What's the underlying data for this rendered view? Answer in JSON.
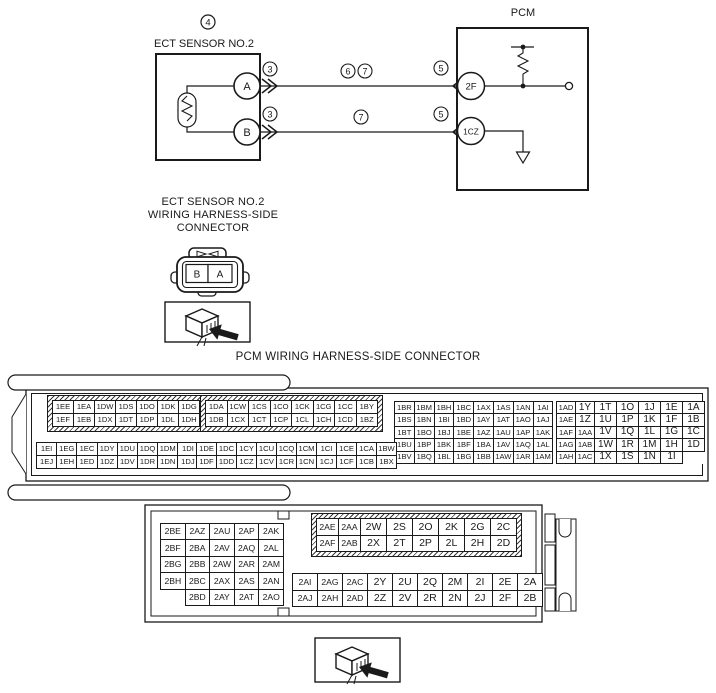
{
  "colors": {
    "ink": "#1a1a1a",
    "paper": "#ffffff"
  },
  "circuit": {
    "callout_sensor": "4",
    "ect_label": "ECT SENSOR NO.2",
    "pin_a": "A",
    "pin_b": "B",
    "callout_conn_a": "3",
    "callout_conn_b": "3",
    "callout_wire_top_1": "6",
    "callout_wire_top_2": "7",
    "callout_wire_bottom": "7",
    "callout_pcm_top": "5",
    "callout_pcm_bottom": "5",
    "pcm_label": "PCM",
    "pin_2f": "2F",
    "pin_1cz": "1CZ"
  },
  "ect_connector": {
    "title_lines": [
      "ECT SENSOR NO.2",
      "WIRING HARNESS-SIDE",
      "CONNECTOR"
    ],
    "terminal_left": "B",
    "terminal_right": "A",
    "view_icon": "connector-view-arrow-icon"
  },
  "pcm_section": {
    "title": "PCM WIRING HARNESS-SIDE CONNECTOR",
    "view_icon": "connector-view-arrow-icon"
  },
  "connector1": {
    "blocks": [
      {
        "name": "block-1E-top",
        "rows": [
          [
            "1EE",
            "1EA",
            "1DW",
            "1DS",
            "1DO",
            "1DK",
            "1DG"
          ],
          [
            "1EF",
            "1EB",
            "1DX",
            "1DT",
            "1DP",
            "1DL",
            "1DH"
          ]
        ]
      },
      {
        "name": "block-1C-top",
        "rows": [
          [
            "1DA",
            "1CW",
            "1CS",
            "1CO",
            "1CK",
            "1CG",
            "1CC",
            "1BY"
          ],
          [
            "1DB",
            "1CX",
            "1CT",
            "1CP",
            "1CL",
            "1CH",
            "1CD",
            "1BZ"
          ]
        ]
      },
      {
        "name": "block-1B",
        "rows": [
          [
            "1BR",
            "1BM",
            "1BH",
            "1BC",
            "1AX",
            "1AS",
            "1AN",
            "1AI"
          ],
          [
            "1BS",
            "1BN",
            "1BI",
            "1BD",
            "1AY",
            "1AT",
            "1AO",
            "1AJ"
          ],
          [
            "1BT",
            "1BO",
            "1BJ",
            "1BE",
            "1AZ",
            "1AU",
            "1AP",
            "1AK"
          ],
          [
            "1BU",
            "1BP",
            "1BK",
            "1BF",
            "1BA",
            "1AV",
            "1AQ",
            "1AL"
          ],
          [
            "1BV",
            "1BQ",
            "1BL",
            "1BG",
            "1BB",
            "1AW",
            "1AR",
            "1AM"
          ]
        ]
      },
      {
        "name": "block-1A",
        "rows": [
          [
            "1AD",
            "1Y",
            "1T",
            "1O",
            "1J",
            "1E",
            "1A"
          ],
          [
            "1AE",
            "1Z",
            "1U",
            "1P",
            "1K",
            "1F",
            "1B"
          ],
          [
            "1AF",
            "1AA",
            "1V",
            "1Q",
            "1L",
            "1G",
            "1C"
          ],
          [
            "1AG",
            "1AB",
            "1W",
            "1R",
            "1M",
            "1H",
            "1D"
          ],
          [
            "1AH",
            "1AC",
            "1X",
            "1S",
            "1N",
            "1I",
            ""
          ]
        ]
      },
      {
        "name": "block-1E-bottom",
        "rows": [
          [
            "1EI",
            "1EG",
            "1EC",
            "1DY",
            "1DU",
            "1DQ",
            "1DM",
            "1DI"
          ],
          [
            "1EJ",
            "1EH",
            "1ED",
            "1DZ",
            "1DV",
            "1DR",
            "1DN",
            "1DJ"
          ]
        ]
      },
      {
        "name": "block-1C-bottom",
        "rows": [
          [
            "1DE",
            "1DC",
            "1CY",
            "1CU",
            "1CQ",
            "1CM",
            "1CI",
            "1CE",
            "1CA",
            "1BW"
          ],
          [
            "1DF",
            "1DD",
            "1CZ",
            "1CV",
            "1CR",
            "1CN",
            "1CJ",
            "1CF",
            "1CB",
            "1BX"
          ]
        ]
      }
    ]
  },
  "connector2": {
    "blocks": [
      {
        "name": "block-2B-left",
        "rows": [
          [
            "2BE",
            "2AZ",
            "2AU",
            "2AP",
            "2AK"
          ],
          [
            "2BF",
            "2BA",
            "2AV",
            "2AQ",
            "2AL"
          ],
          [
            "2BG",
            "2BB",
            "2AW",
            "2AR",
            "2AM"
          ],
          [
            "2BH",
            "2BC",
            "2AX",
            "2AS",
            "2AN"
          ],
          [
            "",
            "2BD",
            "2AY",
            "2AT",
            "2AO"
          ]
        ]
      },
      {
        "name": "block-2A-top",
        "rows": [
          [
            "2AE",
            "2AA",
            "2W",
            "2S",
            "2O",
            "2K",
            "2G",
            "2C"
          ],
          [
            "2AF",
            "2AB",
            "2X",
            "2T",
            "2P",
            "2L",
            "2H",
            "2D"
          ]
        ]
      },
      {
        "name": "block-2A-bottom",
        "rows": [
          [
            "2AI",
            "2AG",
            "2AC",
            "2Y",
            "2U",
            "2Q",
            "2M",
            "2I",
            "2E",
            "2A"
          ],
          [
            "2AJ",
            "2AH",
            "2AD",
            "2Z",
            "2V",
            "2R",
            "2N",
            "2J",
            "2F",
            "2B"
          ]
        ]
      }
    ]
  }
}
